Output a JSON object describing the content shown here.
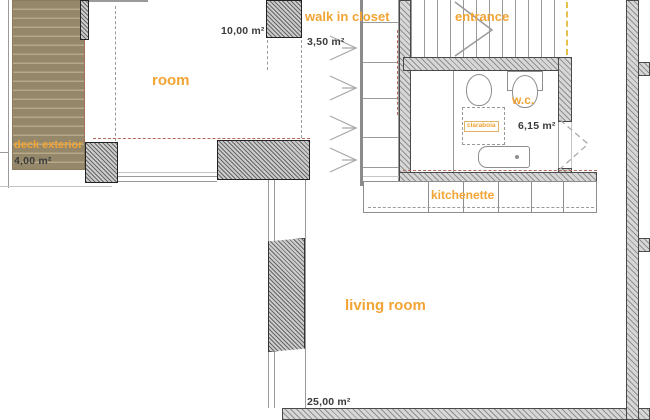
{
  "title": "apartment floor plan",
  "colors": {
    "label_accent": "#f2a434",
    "measurement_text": "#3b3b3b",
    "wall_fill": "#d7d7d7",
    "deck_fill": "#95876a",
    "red_dash": "#b5685a"
  },
  "rooms": {
    "deck": {
      "label": "deck exterior",
      "area": "4,00 m²"
    },
    "room": {
      "label": "room",
      "area": "10,00 m²"
    },
    "closet": {
      "label": "walk in closet",
      "area": "3,50 m²"
    },
    "entrance": {
      "label": "entrance"
    },
    "wc": {
      "label": "w.c.",
      "area": "6,15 m²",
      "skylight_label": "claraboia"
    },
    "kitchenette": {
      "label": "kitchenette"
    },
    "living": {
      "label": "living room",
      "area": "25,00 m²"
    }
  }
}
